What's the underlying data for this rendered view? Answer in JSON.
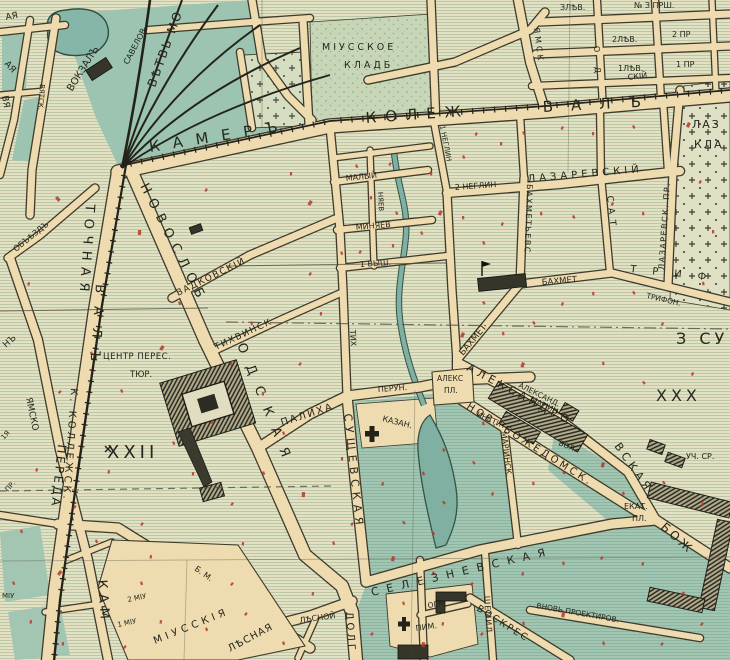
{
  "map": {
    "labels": {
      "vokzal": "ВОКЗАЛЪ",
      "savyolov": "САВЕЛОВ.",
      "vetv": "ВѢТВЬ МО",
      "vyatsk": "ВЯТСК.",
      "frag_aya1": "АЯ",
      "frag_aya2": "АЯ",
      "frag_vya": "ВЯ",
      "obezd": "ОБЪѢЗДЪ",
      "kamer": "КАМЕРЪ",
      "kolezh": "КОЛЕЖ",
      "val": "ВАЛЪ",
      "miusskoe": "МІУССКОЕ",
      "kladb": "КЛАДБ",
      "lev3": "ЗЛѢВ.",
      "pr3": "№ З ПРШ.",
      "lev2": "2ЛѢВ.",
      "pr2": "2 ПР",
      "lev1": "1ЛѢВ.",
      "pr1": "1 ПР",
      "yamsk": "ЯМСК",
      "frag_od": "О Д",
      "neglin1": "1 НЕГЛИН",
      "neglin2": "2 НЕГЛИН",
      "lazarevskiy": "ЛАЗАРЕВСКІЙ",
      "lazar_pr": "ЛАЗАРЕВСК. ПР.",
      "skij": "СКІЙ",
      "laz": "ЛАЗ",
      "kla": "КЛА",
      "bakhmet_v": "БАХМЕТЬЕВС",
      "sat": "САТ",
      "bakhmet": "БАХМЕТ",
      "bakhmet_d": "БАХМЕТ",
      "trif": "ТРИФ",
      "trifon": "ТРИФОН.",
      "vadkovskiy": "ВАДКОВСКІЙ",
      "tikhvinsk": "ТИХВИНСК",
      "tikh": "ТИХ",
      "malyj": "МАЛЫЙ",
      "minyaev": "МИНЯЕВ",
      "nyaev": "НЯЕВ",
      "vysh": "1 ВЫШ.",
      "novoslob1": "НОВОСЛОБ",
      "novoslob2": "ОДСКАЯ",
      "tochnaya": "ТОЧНАЯ",
      "pereda": "ПЕРЕДА",
      "kollezhsk": "К. КОЛЛЕЖСК.",
      "val_v": "ВАЛЪ",
      "yamsko": "ЯМСКО",
      "frag_n": "НЪ",
      "frag_1ya": "1Я",
      "frag_pr": "ПР.",
      "kam": "КАМ",
      "tyur1": "ЦЕНТР ПЕРЕС.",
      "tyur2": "ТЮР.",
      "xxii": "XXII",
      "palikha": "ПАЛИХА",
      "perun": "ПЕРУН.",
      "aleks": "АЛЕКС",
      "aleks_pl": "ПЛ.",
      "kazan": "КАЗАН.",
      "sushchevskaya": "СУЩЕВСКАЯ",
      "seleznevskaya": "СЕЛЕЗНЕВСКАЯ",
      "dolg": "ДОЛГ",
      "lesnaya": "ЛѢСНАЯ",
      "lesnoy": "ЛѢСНОЙ",
      "miu_b": "Б. М.",
      "miusskiya": "МІУССКІЯ",
      "miu2": "2 МІУ",
      "miu1": "1 МІУ",
      "miu0": "МІУ",
      "mariinsk": "МАРІИНСК.",
      "shemil": "ШЕМИЛ",
      "voskres": "ВОСКРЕС",
      "vnov": "ВНОВЬ ПРОЕКТИРОВ.",
      "ogn": "ОГН.",
      "pim": "ПИМ.",
      "novbozh": "НОВ. БОЖЕДОМСК.",
      "aleksandro": "АЛЕКСАНДРО",
      "vskaya": "ВСКАЯ",
      "institut": "ИНСТИТ.",
      "aleksand": "АЛЕКСАНД.",
      "mariin": "МАРІИН.",
      "bol": "БОЛ.",
      "ekat": "ЕКАТ.",
      "ekat_pl": "ПЛ.",
      "uchsr": "УЧ. СР.",
      "bozh": "БОЖ",
      "zsu": "З СУ",
      "xxx": "XXX"
    },
    "colors": {
      "paper": "#e3e1c2",
      "stripe": "#bac7a8",
      "street": "#eedcb0",
      "casing": "#3f3b2c",
      "teal": "#9cc4b0",
      "tealstripe": "#8db6a2",
      "water": "#7fb0a2",
      "waterdark": "#32544a",
      "ink": "#26261c",
      "red": "#b03a2a",
      "building": "#36352a",
      "cemetery": "#dfe0c4",
      "cemgreen": "#c6d6b6"
    }
  }
}
